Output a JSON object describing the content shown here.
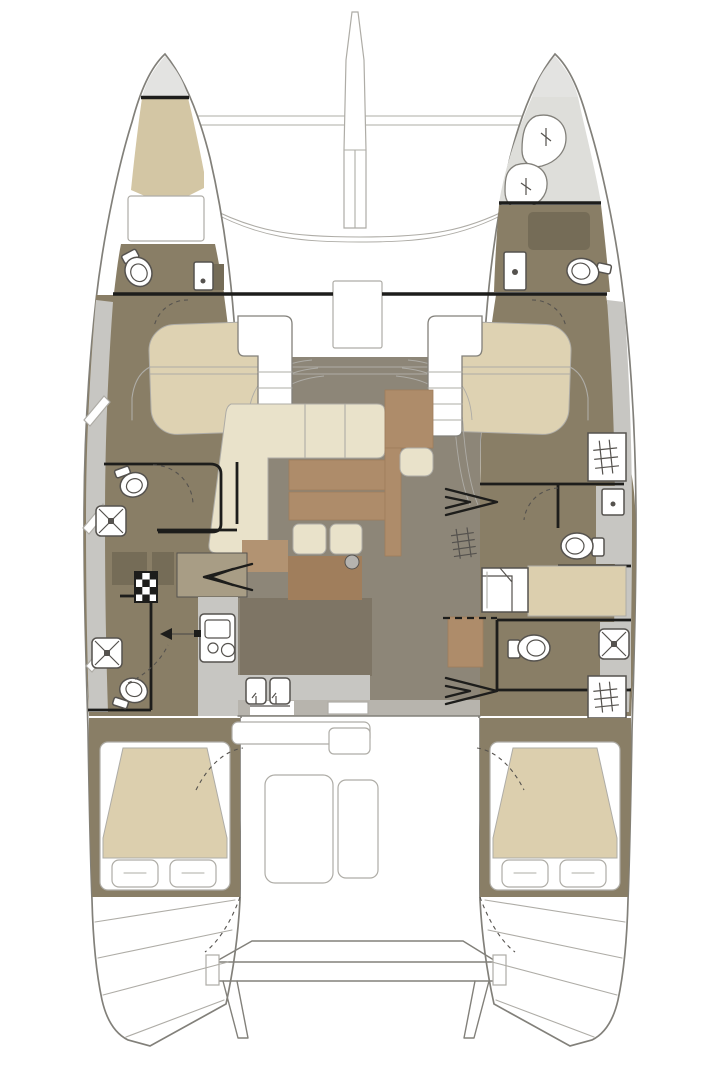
{
  "diagram": {
    "type": "floor-plan",
    "subject": "sailing catamaran accommodation layout, top view",
    "palette": {
      "page_bg": "#ffffff",
      "line": "#82807a",
      "line_soft": "#aeaca6",
      "wall": "#1d1d1b",
      "bow_tip_gray": "#e3e3e1",
      "crew_area_gray": "#dededa",
      "berth_tan": "#d3c6a4",
      "bed_beige": "#ded2b2",
      "mattress_beige": "#dccfae",
      "floor_brown": "#897e66",
      "floor_brown_dark": "#7e7565",
      "salon_floor": "#8d8678",
      "sofa_cream": "#e9e2ca",
      "table_brown": "#ae8c6a",
      "table_brown_dark": "#a07e5c",
      "counter_gray": "#c7c6c2",
      "counter_gray_dark": "#b7b4ad",
      "fixture_white": "#ffffff",
      "fixture_stroke": "#55524e",
      "stairwell_tan": "#a89d85",
      "cabinet_dark": "#756c57",
      "accent_circle_gray": "#b5b3af"
    },
    "areas": {
      "port_bow_cabin": "Port bow cabin",
      "port_bow_head": "Port bow head",
      "starboard_crew_area": "Starboard crew area",
      "starboard_bow_cabin": "Starboard bow cabin",
      "foredeck": "Foredeck, trampoline and longeron",
      "salon": "Salon with L-sofa and tables",
      "galley": "Galley with stove and double sink",
      "port_forward_head": "Port forward head",
      "port_aft_head": "Port aft head",
      "port_forward_berth": "Port forward berth",
      "starboard_forward_berth": "Starboard forward berth",
      "starboard_forward_head": "Starboard forward head",
      "starboard_aft_head": "Starboard aft head",
      "starboard_desk_cabin": "Starboard cabin desk area",
      "port_aft_cabin": "Port aft cabin with island bed",
      "starboard_aft_cabin": "Starboard aft cabin with island bed",
      "cockpit": "Aft cockpit with table and bench",
      "aft_platform": "Aft crossbeam, davits and transom steps",
      "port_companionway": "Port companionway stairs",
      "starboard_companionway": "Starboard companionway stairs"
    }
  }
}
